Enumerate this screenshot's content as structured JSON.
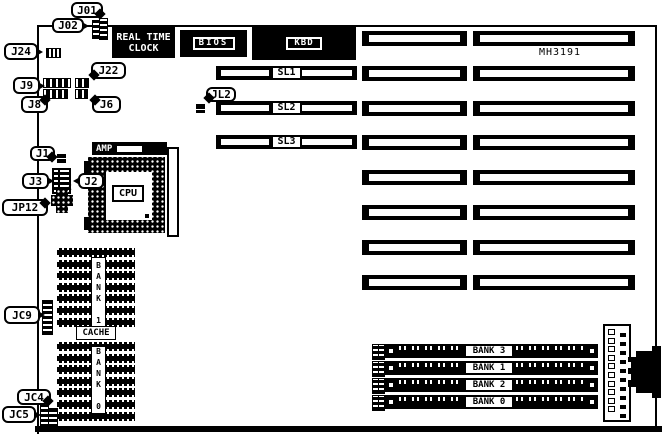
{
  "diagram": {
    "board_model": "MH3191",
    "callouts": {
      "j01": "J01",
      "j02": "J02",
      "j24": "J24",
      "j9": "J9",
      "j22": "J22",
      "j8": "J8",
      "j6": "J6",
      "jl2": "JL2",
      "j1": "J1",
      "j3": "J3",
      "j2": "J2",
      "jp12": "JP12",
      "jc9": "JC9",
      "jc4": "JC4",
      "jc5": "JC5"
    },
    "components": {
      "rtc": "REAL TIME\nCLOCK",
      "bios": "BIOS",
      "kbd": "KBD",
      "slots": [
        "SL1",
        "SL2",
        "SL3"
      ],
      "amp": "AMP",
      "cpu": "CPU",
      "cache": "CACHE",
      "bank_top": "BANK 1",
      "bank_bottom": "BANK 0",
      "jumper_pin": "2",
      "simm_banks": [
        "BANK 3",
        "BANK 1",
        "BANK 2",
        "BANK 0"
      ]
    }
  }
}
